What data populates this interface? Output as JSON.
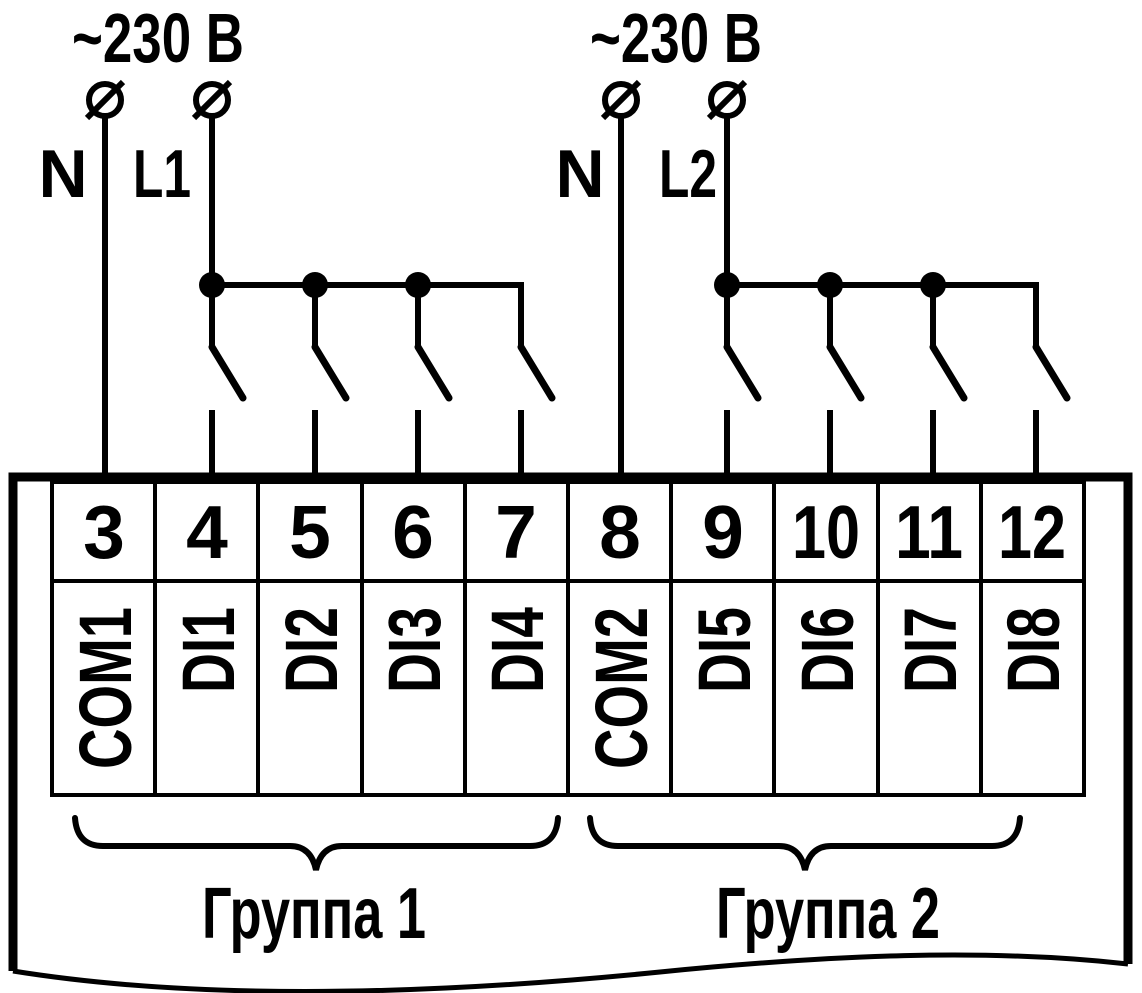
{
  "diagram": {
    "title": "Digital inputs wiring diagram",
    "colors": {
      "ink": "#000000",
      "paper": "#ffffff"
    },
    "power_groups": [
      {
        "voltage_label": "~230 В",
        "neutral_label": "N",
        "line_label": "L1"
      },
      {
        "voltage_label": "~230 В",
        "neutral_label": "N",
        "line_label": "L2"
      }
    ],
    "terminals": [
      {
        "number": "3",
        "label": "COM1"
      },
      {
        "number": "4",
        "label": "DI1"
      },
      {
        "number": "5",
        "label": "DI2"
      },
      {
        "number": "6",
        "label": "DI3"
      },
      {
        "number": "7",
        "label": "DI4"
      },
      {
        "number": "8",
        "label": "COM2"
      },
      {
        "number": "9",
        "label": "DI5"
      },
      {
        "number": "10",
        "label": "DI6"
      },
      {
        "number": "11",
        "label": "DI7"
      },
      {
        "number": "12",
        "label": "DI8"
      }
    ],
    "input_groups": [
      {
        "label": "Группа 1"
      },
      {
        "label": "Группа 2"
      }
    ]
  }
}
